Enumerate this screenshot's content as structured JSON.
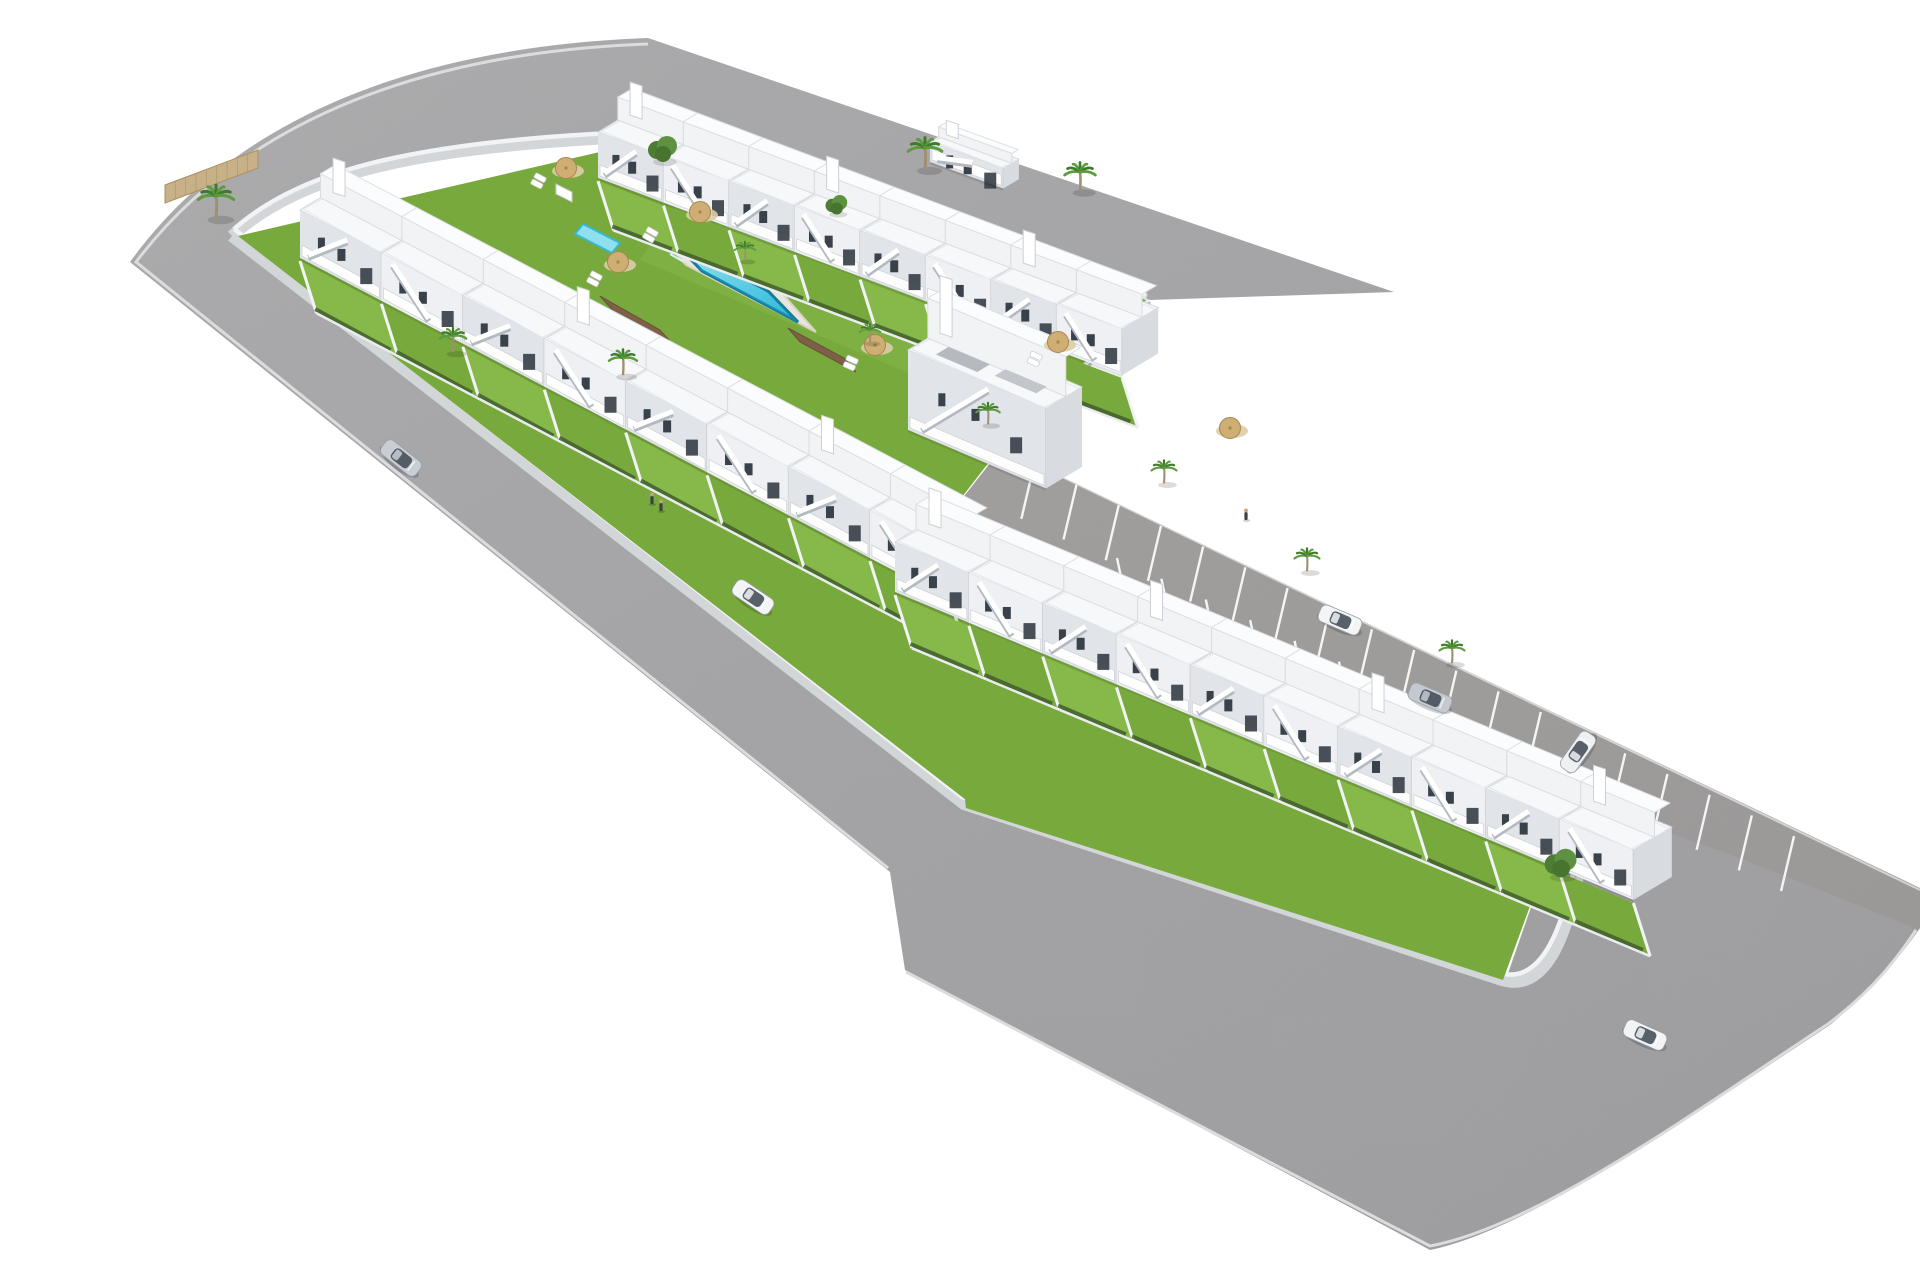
{
  "meta": {
    "description": "aerial-3d-render-of-coastal-residential-development-with-pool",
    "background": "#ffffff"
  },
  "palette": {
    "asphalt": "#a3a3a5",
    "asphaltLight": "#aeaeb0",
    "parkingTint": "#8a7e6c",
    "sidewalk": "#d3d6d9",
    "wallTop": "#f2f3f5",
    "wallShade": "#b9bec4",
    "curb": "#dcdcde",
    "lawn": "#78a93c",
    "lawnAlt": "#86b84a",
    "hedge": "#415f2c",
    "houseWhite": "#ffffff",
    "houseFront": "#eef0f3",
    "houseFrontDeep": "#e1e4e8",
    "houseSide": "#d8dbdf",
    "roof": "#f7f8fa",
    "roofLine": "#d3d6da",
    "backBox": "#f1f3f5",
    "window": "#39414a",
    "stairShadow": "#b3b9c0",
    "poolDeck": "#e9e5da",
    "poolDeckLine": "#d8d3c6",
    "poolRim": "#157c9c",
    "poolWaterA": "#9fe8f2",
    "poolWaterB": "#28b6d8",
    "poolWaterDeep": "#1995b8",
    "kidsPool": "#8fe0ee",
    "wood": "#7d6047",
    "woodLine": "#6b5038",
    "umbrella": "#cfae74",
    "umbrellaEdge": "#a8854e",
    "gravel": "#dbcda8",
    "palmFrond": "#3f7a2d",
    "palmFrondLight": "#5d9b3f",
    "palmTrunk": "#a0906f",
    "treeGreen": "#4d7c34",
    "fenceTan": "#c8b189",
    "fenceTanLine": "#a8905f",
    "bayLine": "#ffffff",
    "carGlass": "#47505a",
    "skin": "#caa07a",
    "personBody": "#3a4046"
  },
  "roads": {
    "asphaltPath": "M 1394,292 L 648,38 C 430,46 240,110 130,262 L 890,872 L 905,970 L 1430,1250 C 1530,1230 1700,1110 1830,1025 C 1878,985 1905,950 1920,928 L 1920,888 L 1002,448 L 935,533 L 1570,795 L 1505,982 L 966,806 L 232,232 C 300,170 420,140 660,132 L 1150,300 Z",
    "parkingTintPoints": "1002,448 1920,890 1920,930 1745,860 1570,797 935,533",
    "sidewalkPath": "M 660,136 L 1146,300 M 232,236 C 300,174 420,144 660,136 M 232,236 L 964,804 L 1502,980 Q 1570,1000 1588,800",
    "wallPath": "M 660,131 L 1146,295 M 234,229 C 302,169 420,139 660,131 M 234,229 L 962,797 L 1500,973 Q 1564,991 1584,799",
    "curbOuterTop": "M 648,44 C 434,52 248,114 136,262 L 888,868",
    "curbOuterBottom": "M 906,972 L 1430,1246 C 1538,1226 1700,1108 1828,1024 C 1876,988 1900,954 1916,930",
    "blockRightWall": "M 1146,298 L 1004,446",
    "blockRightWallShadow": "M 1150,302 L 1008,450"
  },
  "greens": {
    "upperBlock": "238,236 660,138 1146,300 1000,448 938,528 966,800",
    "lowerBlock": "935,535 1570,797 1503,980 966,808"
  },
  "parkingBays": {
    "top": {
      "x": 1002,
      "y": 448,
      "ux": 0.898,
      "uy": 0.44,
      "start": 36,
      "spacing": 47,
      "count": 19,
      "vx": -13,
      "vy": 55
    },
    "bottom": {
      "x": 1128,
      "y": 610,
      "ux": 0.906,
      "uy": 0.423,
      "start": 0,
      "spacing": 49,
      "count": 9,
      "vx": -11,
      "vy": -52
    }
  },
  "pool": {
    "deck": "652,226 782,293 816,332 686,265",
    "water": "672,240 768,291 798,322 702,271",
    "deepEdge": "702,271 798,322 790,316 696,266",
    "kids": "583,224 620,243 612,253 575,234",
    "hut": "556,184 572,192 572,202 556,194",
    "woodDeckA": "600,296 660,330 676,348 616,314",
    "woodDeckB": "788,328 844,358 856,372 800,342"
  },
  "rows": [
    {
      "name": "top-row",
      "ax": 598,
      "ay": 178,
      "dx": 0.936,
      "dy": 0.352,
      "w": 70,
      "h": 46,
      "d": 60,
      "g": 52,
      "units": 8
    },
    {
      "name": "left-row",
      "ax": 300,
      "ay": 258,
      "dx": 0.885,
      "dy": 0.466,
      "w": 92,
      "h": 48,
      "d": 62,
      "g": 55,
      "units": 8
    },
    {
      "name": "lower-row",
      "ax": 895,
      "ay": 592,
      "dx": 0.923,
      "dy": 0.385,
      "w": 80,
      "h": 50,
      "d": 64,
      "g": 56,
      "units": 10
    }
  ],
  "buildings": [
    {
      "name": "central-building",
      "ax": 908,
      "ay": 430,
      "dx": 0.92,
      "dy": 0.39,
      "w": 150,
      "h": 80,
      "d": 60,
      "grayRoof": true
    },
    {
      "name": "utility-building",
      "ax": 930,
      "ay": 162,
      "dx": 0.94,
      "dy": 0.34,
      "w": 78,
      "h": 20,
      "d": 26
    }
  ],
  "fence": {
    "points": "165,185 258,150 258,168 165,203",
    "slats": 9
  },
  "palms": [
    {
      "x": 216,
      "y": 196,
      "s": 1.2
    },
    {
      "x": 453,
      "y": 336,
      "s": 0.9
    },
    {
      "x": 623,
      "y": 358,
      "s": 0.95
    },
    {
      "x": 925,
      "y": 148,
      "s": 1.15
    },
    {
      "x": 1080,
      "y": 172,
      "s": 1.05
    },
    {
      "x": 745,
      "y": 248,
      "s": 0.7
    },
    {
      "x": 870,
      "y": 330,
      "s": 0.7
    },
    {
      "x": 988,
      "y": 410,
      "s": 0.8
    },
    {
      "x": 1164,
      "y": 468,
      "s": 0.85
    },
    {
      "x": 1307,
      "y": 556,
      "s": 0.85
    },
    {
      "x": 1452,
      "y": 648,
      "s": 0.85
    }
  ],
  "leafTrees": [
    {
      "x": 662,
      "y": 148,
      "s": 1.0
    },
    {
      "x": 836,
      "y": 204,
      "s": 0.75
    },
    {
      "x": 1560,
      "y": 862,
      "s": 1.1
    }
  ],
  "umbrellas": [
    {
      "x": 566,
      "y": 168
    },
    {
      "x": 618,
      "y": 262
    },
    {
      "x": 700,
      "y": 212
    },
    {
      "x": 875,
      "y": 345
    },
    {
      "x": 1058,
      "y": 342
    },
    {
      "x": 1230,
      "y": 428
    }
  ],
  "loungers": [
    {
      "x": 540,
      "y": 178,
      "a": 28
    },
    {
      "x": 596,
      "y": 276,
      "a": 28
    },
    {
      "x": 852,
      "y": 360,
      "a": 24
    },
    {
      "x": 1036,
      "y": 356,
      "a": 24
    },
    {
      "x": 652,
      "y": 232,
      "a": 30
    }
  ],
  "cars": [
    {
      "x": 401,
      "y": 458,
      "a": 38,
      "c": "#c9ced4"
    },
    {
      "x": 753,
      "y": 597,
      "a": 34,
      "c": "#f2f4f6"
    },
    {
      "x": 1340,
      "y": 620,
      "a": 23,
      "c": "#f2f4f6"
    },
    {
      "x": 1430,
      "y": 698,
      "a": 23,
      "c": "#c4c9cf"
    },
    {
      "x": 1578,
      "y": 752,
      "a": -55,
      "c": "#eef1f3"
    },
    {
      "x": 1645,
      "y": 1035,
      "a": 24,
      "c": "#f2f4f6"
    }
  ],
  "people": [
    {
      "x": 652,
      "y": 500
    },
    {
      "x": 661,
      "y": 507
    },
    {
      "x": 1246,
      "y": 516
    }
  ]
}
